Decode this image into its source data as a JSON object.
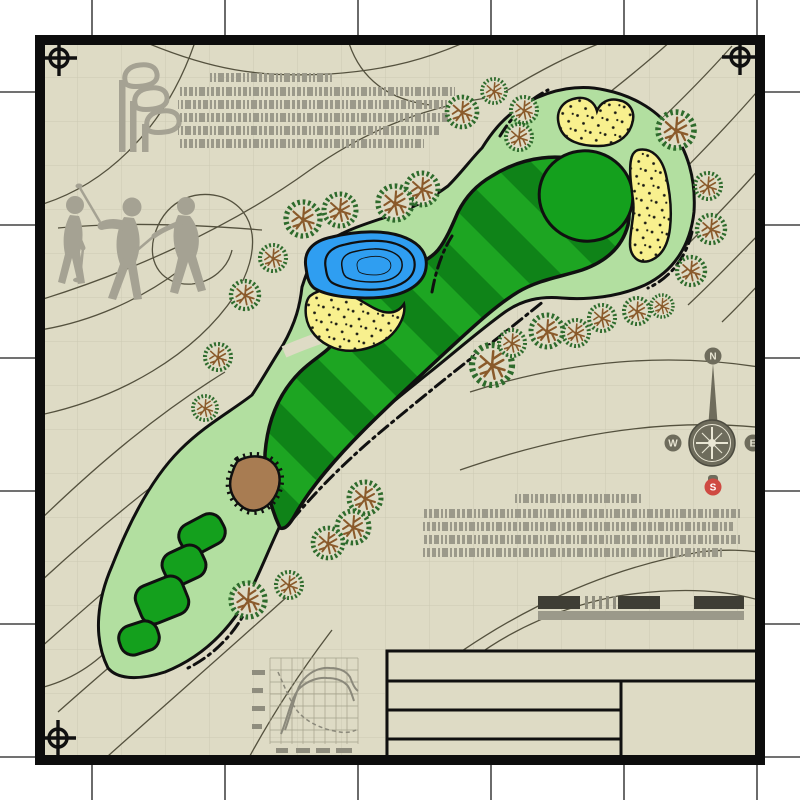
{
  "plan": {
    "title": "golf-hole-site-plan",
    "compass": {
      "north": "N",
      "east": "E",
      "south": "S",
      "west": "W"
    },
    "colors": {
      "page": "#ffffff",
      "paper": "#dedbc5",
      "grid": "#ccc9b2",
      "contour": "#54513e",
      "silhouette": "#a5a293",
      "greek_text": "#9b998a",
      "rough": "#b2dfa0",
      "fairway_light": "#1da522",
      "fairway_dark": "#0f8318",
      "green": "#14a01d",
      "sand": "#f8f08e",
      "water": "#2f9ef1",
      "mound": "#a87c52",
      "tree_ring": "#2e6b2c",
      "tree_branch": "#8a5a2b",
      "outline": "#101010",
      "compass_body": "#6e6c5c",
      "compass_face": "#e9e6d4",
      "compass_south": "#cf4a42",
      "scale_dark": "#3f3e35",
      "scale_gray": "#9b998a"
    },
    "features": {
      "trees": [
        {
          "x": 462,
          "y": 112,
          "r": 15
        },
        {
          "x": 494,
          "y": 91,
          "r": 12
        },
        {
          "x": 524,
          "y": 110,
          "r": 13
        },
        {
          "x": 519,
          "y": 137,
          "r": 13
        },
        {
          "x": 676,
          "y": 130,
          "r": 18
        },
        {
          "x": 708,
          "y": 186,
          "r": 13
        },
        {
          "x": 711,
          "y": 229,
          "r": 14
        },
        {
          "x": 691,
          "y": 271,
          "r": 14
        },
        {
          "x": 422,
          "y": 189,
          "r": 16
        },
        {
          "x": 395,
          "y": 203,
          "r": 17
        },
        {
          "x": 340,
          "y": 210,
          "r": 16
        },
        {
          "x": 303,
          "y": 219,
          "r": 17
        },
        {
          "x": 273,
          "y": 258,
          "r": 13
        },
        {
          "x": 245,
          "y": 295,
          "r": 14
        },
        {
          "x": 218,
          "y": 357,
          "r": 13
        },
        {
          "x": 205,
          "y": 408,
          "r": 12
        },
        {
          "x": 492,
          "y": 365,
          "r": 20
        },
        {
          "x": 512,
          "y": 343,
          "r": 13
        },
        {
          "x": 547,
          "y": 331,
          "r": 16
        },
        {
          "x": 576,
          "y": 333,
          "r": 13
        },
        {
          "x": 602,
          "y": 318,
          "r": 13
        },
        {
          "x": 637,
          "y": 311,
          "r": 13
        },
        {
          "x": 662,
          "y": 306,
          "r": 11
        },
        {
          "x": 365,
          "y": 498,
          "r": 16
        },
        {
          "x": 353,
          "y": 527,
          "r": 16
        },
        {
          "x": 328,
          "y": 543,
          "r": 15
        },
        {
          "x": 289,
          "y": 585,
          "r": 13
        },
        {
          "x": 248,
          "y": 600,
          "r": 17
        }
      ],
      "tee_boxes": [
        {
          "x": 202,
          "y": 534,
          "w": 46,
          "h": 32,
          "rot": -28
        },
        {
          "x": 184,
          "y": 565,
          "w": 42,
          "h": 34,
          "rot": -25
        },
        {
          "x": 162,
          "y": 600,
          "w": 50,
          "h": 40,
          "rot": -22
        },
        {
          "x": 139,
          "y": 638,
          "w": 40,
          "h": 30,
          "rot": -18
        }
      ]
    }
  }
}
